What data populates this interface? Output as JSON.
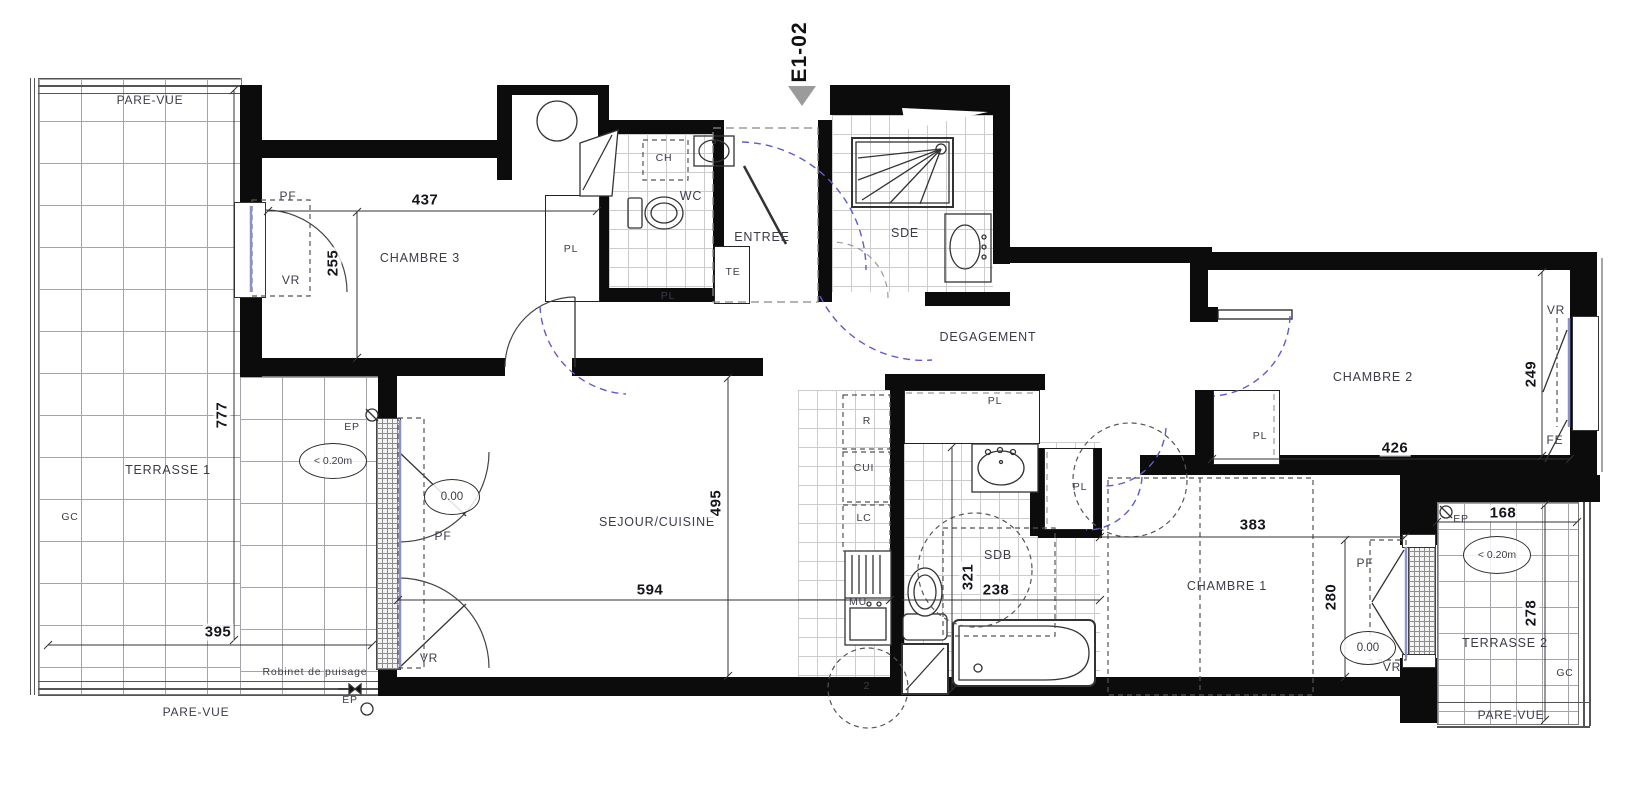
{
  "unit": {
    "id": "E1-02"
  },
  "rooms": {
    "chambre3": "CHAMBRE 3",
    "chambre2": "CHAMBRE 2",
    "chambre1": "CHAMBRE 1",
    "sejour": "SEJOUR/CUISINE",
    "entree": "ENTREE",
    "degagement": "DEGAGEMENT",
    "wc": "WC",
    "sde": "SDE",
    "sdb": "SDB",
    "terrasse1": "TERRASSE 1",
    "terrasse2": "TERRASSE 2"
  },
  "dims": {
    "chambre3_w": "437",
    "chambre3_h": "255",
    "sejour_w": "594",
    "sejour_h": "495",
    "sdb_w": "238",
    "sdb_h": "321",
    "chambre1_w": "383",
    "chambre1_h": "280",
    "chambre2_w": "426",
    "chambre2_h": "249",
    "terrasse1_w": "395",
    "terrasse1_h": "777",
    "terrasse2_w": "168",
    "terrasse2_h": "278"
  },
  "tags": {
    "pare_vue": "PARE-VUE",
    "pf": "PF",
    "vr": "VR",
    "fe": "FE",
    "pl": "PL",
    "te": "TE",
    "ch": "CH",
    "ep": "EP",
    "gc": "GC",
    "r": "R",
    "cui": "CUI",
    "lc": "LC",
    "mu": "MU",
    "level": "0.00",
    "threshold": "< 0.20m",
    "robinet": "Robinet de puisage",
    "note2": "2"
  }
}
